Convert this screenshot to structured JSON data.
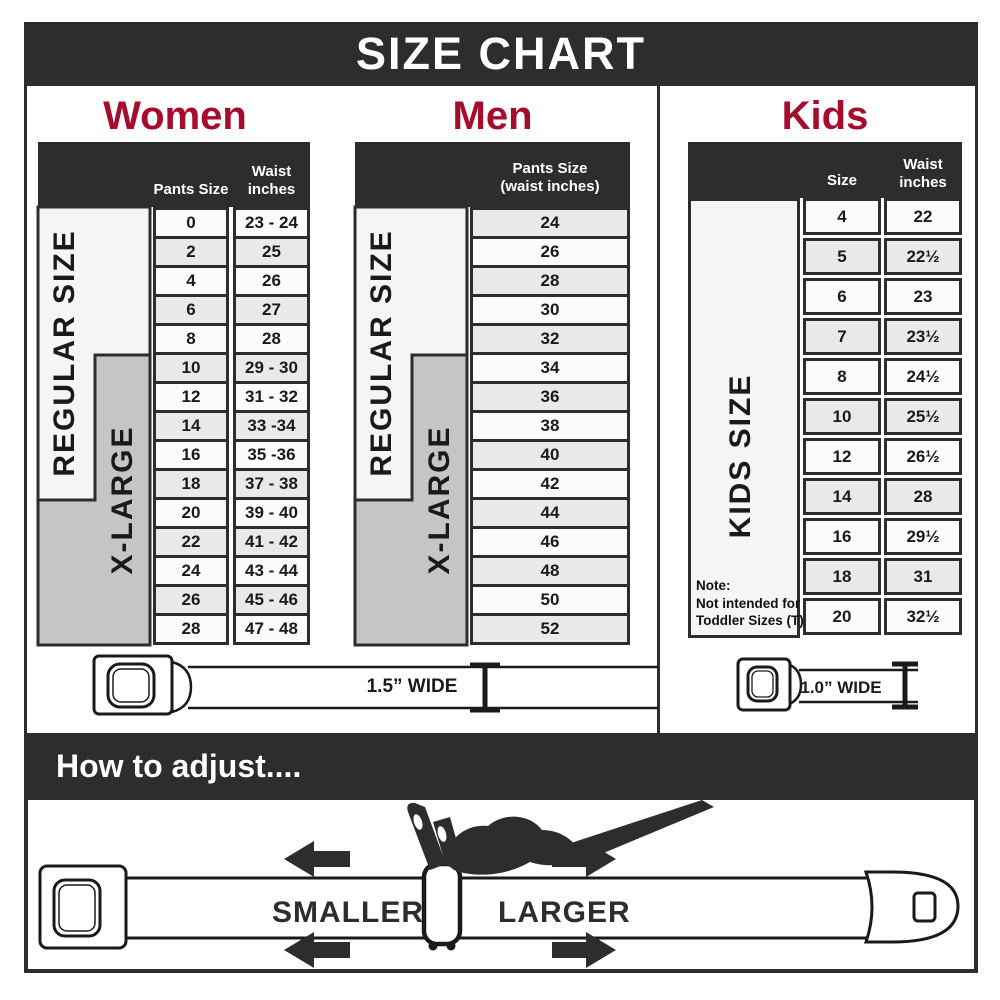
{
  "title": "SIZE CHART",
  "colors": {
    "dark": "#2d2d2d",
    "accent": "#a50d2f",
    "xlarge_gray": "#c5c5c5",
    "row_alt": "#e9e9e9"
  },
  "women": {
    "heading": "Women",
    "pants_header": "Pants Size",
    "waist_header": "Waist\ninches",
    "regular_label": "REGULAR SIZE",
    "xlarge_label": "X-LARGE",
    "sizes": [
      "0",
      "2",
      "4",
      "6",
      "8",
      "10",
      "12",
      "14",
      "16",
      "18",
      "20",
      "22",
      "24",
      "26",
      "28"
    ],
    "waists": [
      "23 - 24",
      "25",
      "26",
      "27",
      "28",
      "29 - 30",
      "31 - 32",
      "33 -34",
      "35 -36",
      "37 - 38",
      "39 - 40",
      "41 - 42",
      "43 - 44",
      "45 - 46",
      "47 - 48"
    ]
  },
  "men": {
    "heading": "Men",
    "pants_header": "Pants Size\n(waist inches)",
    "regular_label": "REGULAR SIZE",
    "xlarge_label": "X-LARGE",
    "sizes": [
      "24",
      "26",
      "28",
      "30",
      "32",
      "34",
      "36",
      "38",
      "40",
      "42",
      "44",
      "46",
      "48",
      "50",
      "52"
    ]
  },
  "kids": {
    "heading": "Kids",
    "size_header": "Size",
    "waist_header": "Waist\ninches",
    "kids_label": "KIDS SIZE",
    "note": "Note:\nNot intended for\nToddler Sizes (T)",
    "sizes": [
      "4",
      "5",
      "6",
      "7",
      "8",
      "10",
      "12",
      "14",
      "16",
      "18",
      "20"
    ],
    "waists": [
      "22",
      "22½",
      "23",
      "23½",
      "24½",
      "25½",
      "26½",
      "28",
      "29½",
      "31",
      "32½"
    ]
  },
  "belts": {
    "adult_width_label": "1.5” WIDE",
    "kids_width_label": "1.0” WIDE"
  },
  "adjust": {
    "heading": "How to adjust....",
    "smaller_label": "SMALLER",
    "larger_label": "LARGER"
  }
}
